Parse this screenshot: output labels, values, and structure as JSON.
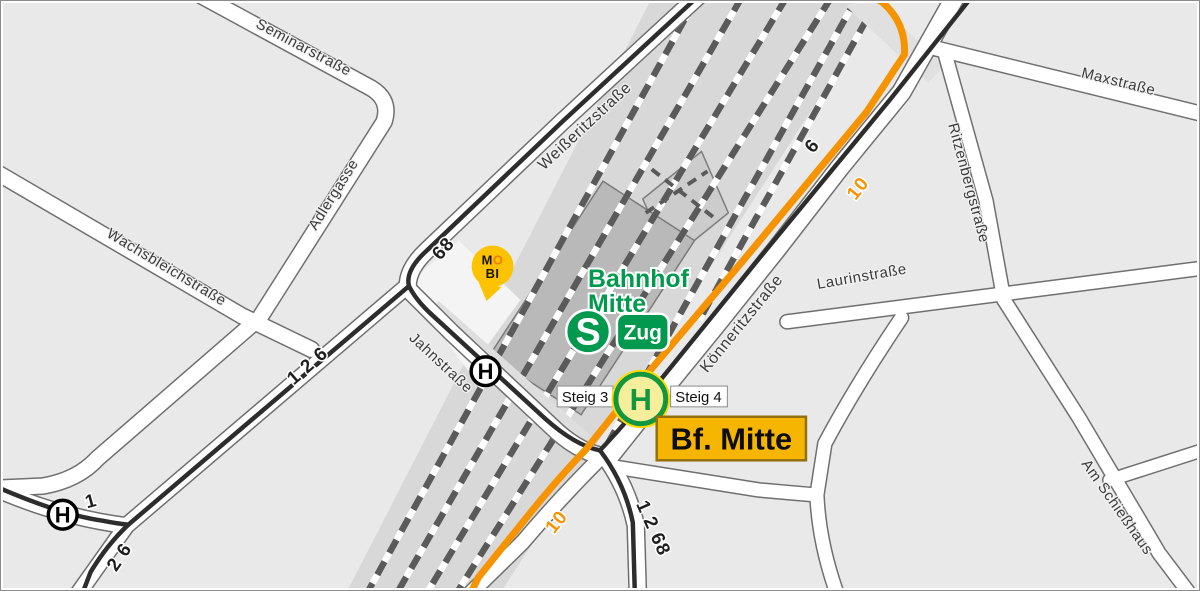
{
  "streets": {
    "seminar": {
      "name": "Seminarstraße"
    },
    "adler": {
      "name": "Adlergasse"
    },
    "wachs": {
      "name": "Wachsbleichstraße"
    },
    "weisseritz": {
      "name": "Weißeritzstraße"
    },
    "jahn": {
      "name": "Jahnstraße"
    },
    "koenneritz": {
      "name": "Könneritzstraße"
    },
    "max": {
      "name": "Maxstraße"
    },
    "ritzenberg": {
      "name": "Ritzenbergstraße"
    },
    "laurin": {
      "name": "Laurinstraße"
    },
    "schiesshaus": {
      "name": "Am Schießhaus"
    }
  },
  "routes": {
    "bus68": "68",
    "tram126": "1 2 6",
    "tram1": "1",
    "tram26": "2 6",
    "tram1268": "1 2 68",
    "tram6": "6",
    "tram10_north": "10",
    "tram10_south": "10"
  },
  "station": {
    "name_line1": "Bahnhof",
    "name_line2": "Mitte",
    "s_bahn_logo": "S",
    "zug_badge": "Zug",
    "name_badge": "Bf. Mitte",
    "platform3": "Steig 3",
    "platform4": "Steig 4"
  },
  "stops": {
    "letter": "H"
  },
  "mobi": {
    "m": "M",
    "o": "O",
    "line2": "BI"
  },
  "colors": {
    "tram10_orange": "#f59300",
    "station_green": "#00994d",
    "badge_yellow": "#f6b500",
    "badge_border": "#93700a",
    "mobi_yellow": "#fdc300",
    "stop_green_fill": "#f5ee9a",
    "block_gray": "#e9e9e9",
    "rail_gray": "#d8d8d8"
  }
}
